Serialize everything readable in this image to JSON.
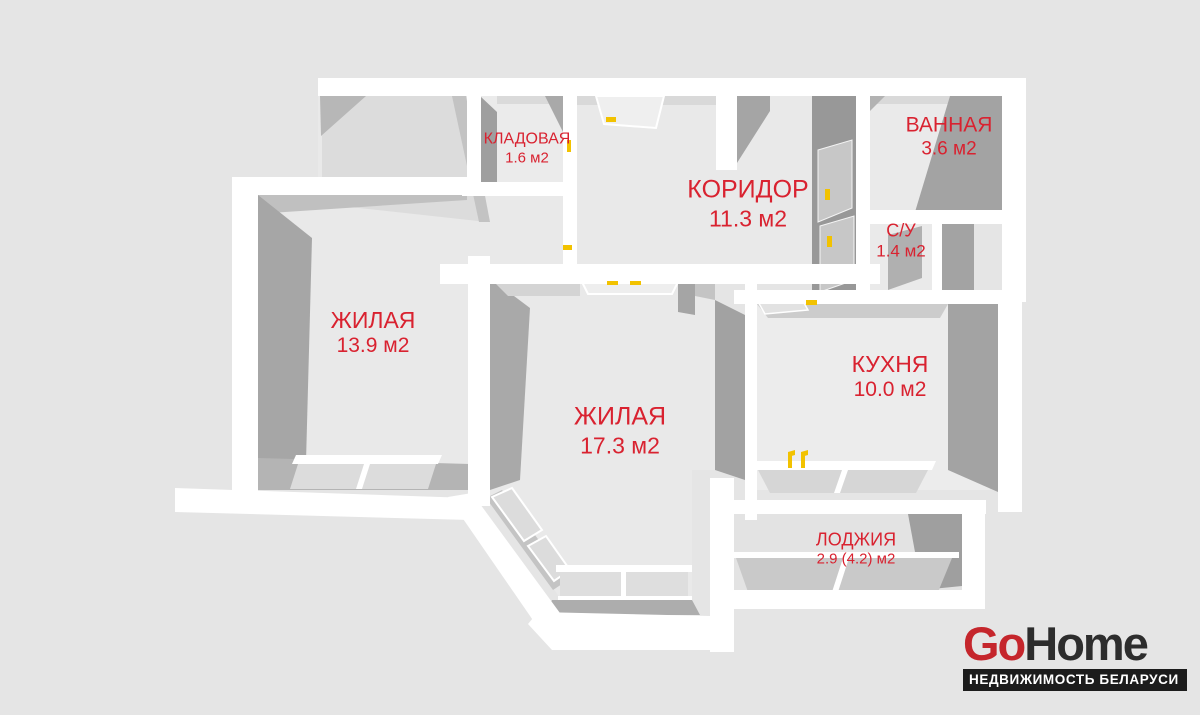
{
  "page": {
    "background": "#e5e5e5",
    "label_color": "#d92230",
    "accent_yellow": "#f2c200"
  },
  "floorplan": {
    "rooms": [
      {
        "id": "kladovaya",
        "name": "КЛАДОВАЯ",
        "area": "1.6 м2"
      },
      {
        "id": "koridor",
        "name": "КОРИДОР",
        "area": "11.3 м2"
      },
      {
        "id": "vannaya",
        "name": "ВАННАЯ",
        "area": "3.6 м2"
      },
      {
        "id": "su",
        "name": "С/У",
        "area": "1.4 м2"
      },
      {
        "id": "zhilaya-1",
        "name": "ЖИЛАЯ",
        "area": "13.9 м2"
      },
      {
        "id": "zhilaya-2",
        "name": "ЖИЛАЯ",
        "area": "17.3 м2"
      },
      {
        "id": "kuhnya",
        "name": "КУХНЯ",
        "area": "10.0 м2"
      },
      {
        "id": "lodzhiya",
        "name": "ЛОДЖИЯ",
        "area": "2.9 (4.2) м2"
      }
    ]
  },
  "logo": {
    "brand_primary": "Go",
    "brand_secondary": "Home",
    "tagline": "НЕДВИЖИМОСТЬ БЕЛАРУСИ"
  }
}
